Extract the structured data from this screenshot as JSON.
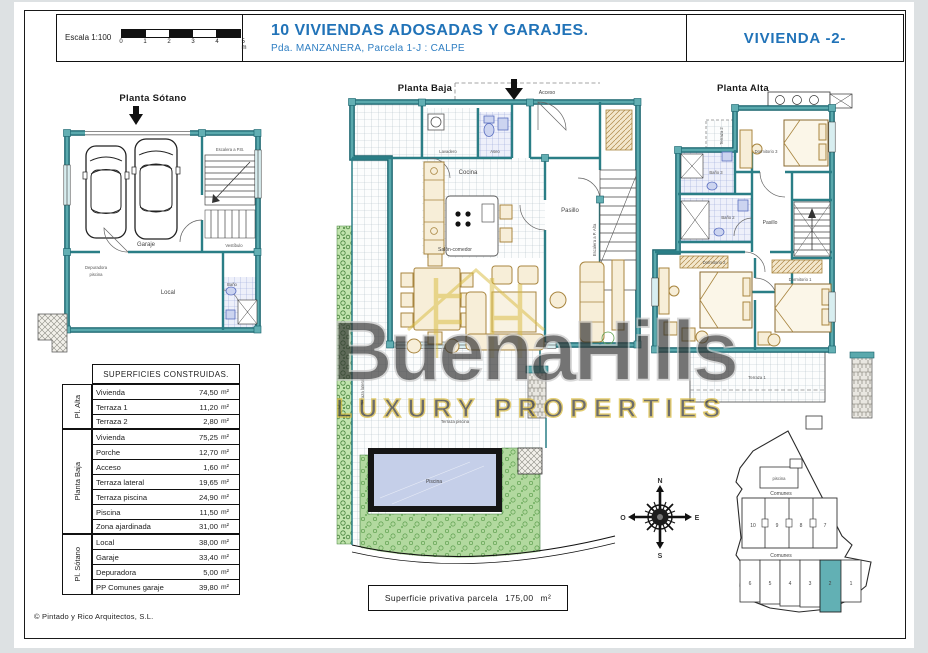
{
  "header": {
    "scale_label": "Escala 1:100",
    "scale_ticks": [
      "0",
      "1",
      "2",
      "3",
      "4",
      "5 m"
    ],
    "title": "10 VIVIENDAS  ADOSADAS Y GARAJES.",
    "subtitle": "Pda. MANZANERA, Parcela 1-J : CALPE",
    "unit_title": "VIVIENDA -2-"
  },
  "plans": {
    "sotano": {
      "title": "Planta Sótano",
      "rooms": {
        "escalera": "Escalera a P.B.",
        "garaje": "Garaje",
        "vestibulo": "Vestíbulo",
        "depuradora_l1": "Depuradora",
        "depuradora_l2": "piscina",
        "local": "Local",
        "bano": "Baño"
      }
    },
    "baja": {
      "title": "Planta Baja",
      "acceso": "Acceso",
      "rooms": {
        "lavadero": "Lavadero",
        "aseo": "Aseo",
        "cocina": "Cocina",
        "pasillo": "Pasillo",
        "escalera": "Escalera a P. Alta",
        "salon": "Salón-comedor",
        "terraza_lateral": "Terraza lateral",
        "terraza_piscina": "Terraza piscina",
        "piscina": "Piscina"
      },
      "caption": {
        "label": "Superficie privativa parcela",
        "value": "175,00",
        "unit": "m²"
      }
    },
    "alta": {
      "title": "Planta Alta",
      "rooms": {
        "terraza2": "Terraza 2",
        "dormitorio3": "Dormitorio 3",
        "bano3": "Baño 3",
        "bano2": "Baño 2",
        "pasillo": "Pasillo",
        "dormitorio2": "Dormitorio 2",
        "dormitorio1": "Dormitorio 1",
        "terraza1": "Terraza 1"
      }
    }
  },
  "surfaces_table": {
    "header": "SUPERFICIES CONSTRUIDAS.",
    "unit": "m²",
    "groups": [
      {
        "name": "Pl. Alta",
        "rows": [
          {
            "label": "Vivienda",
            "value": "74,50"
          },
          {
            "label": "Terraza 1",
            "value": "11,20"
          },
          {
            "label": "Terraza 2",
            "value": "2,80"
          }
        ]
      },
      {
        "name": "Planta Baja",
        "rows": [
          {
            "label": "Vivienda",
            "value": "75,25"
          },
          {
            "label": "Porche",
            "value": "12,70"
          },
          {
            "label": "Acceso",
            "value": "1,60"
          },
          {
            "label": "Terraza lateral",
            "value": "19,65"
          },
          {
            "label": "Terraza piscina",
            "value": "24,90"
          },
          {
            "label": "Piscina",
            "value": "11,50"
          },
          {
            "label": "Zona ajardinada",
            "value": "31,00"
          }
        ]
      },
      {
        "name": "Pl. Sótano",
        "rows": [
          {
            "label": "Local",
            "value": "38,00"
          },
          {
            "label": "Garaje",
            "value": "33,40"
          },
          {
            "label": "Depuradora",
            "value": "5,00"
          },
          {
            "label": "PP Comunes garaje",
            "value": "39,80"
          }
        ]
      }
    ]
  },
  "compass": {
    "north": "N",
    "east": "E",
    "south": "S",
    "west": "O"
  },
  "site_plan": {
    "pool_label": "piscina",
    "comunes_top": "Comunes",
    "comunes_bottom": "Comunes",
    "upper_units": [
      "10",
      "9",
      "8",
      "7"
    ],
    "lower_units": [
      "6",
      "5",
      "4",
      "3",
      "2",
      "1"
    ],
    "highlighted_unit": "2",
    "highlight_color": "#62b0b4"
  },
  "watermark": {
    "name": "BuenaHills",
    "tagline": "LUXURY PROPERTIES"
  },
  "footer": {
    "copyright": "© Pintado y Rico Arquitectos, S.L."
  },
  "colors": {
    "accent_blue": "#2173b8",
    "wall_teal": "#4e9ca0",
    "pool": "#c5cfe9",
    "garden": "#a9d698"
  }
}
